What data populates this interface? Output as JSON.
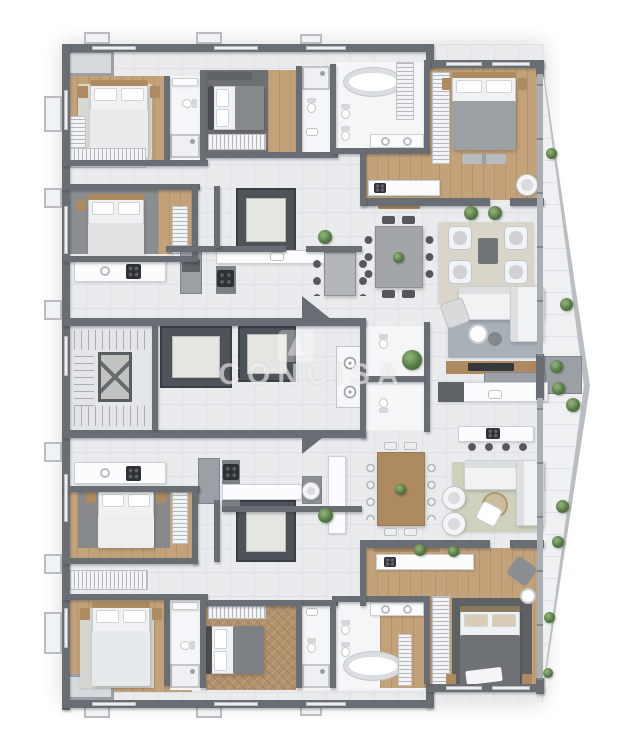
{
  "watermark": {
    "text": "CONCISA"
  },
  "colors": {
    "bg": "#ffffff",
    "wall": "#696e74",
    "win": "#b7bbbf",
    "floor": "#e9ebed",
    "floor-line": "#dee1e3",
    "wood": "#c3a27a",
    "wood-furn": "#ad8a5f",
    "white-fixture": "#f5f6f7",
    "marble": "#fbfcfd",
    "cabinet": "#9aa0a5",
    "bed-white": "#eff1f2",
    "bed-gray": "#9aa0a4",
    "sofa": "#f1f2f3",
    "chair-dark": "#54585c",
    "plant": "#567a44",
    "amber": "#d9a13d",
    "balcony": "#eef0f1",
    "balcony-wall": "#b9bec2",
    "watermark": "rgba(255,255,255,0.55)"
  }
}
